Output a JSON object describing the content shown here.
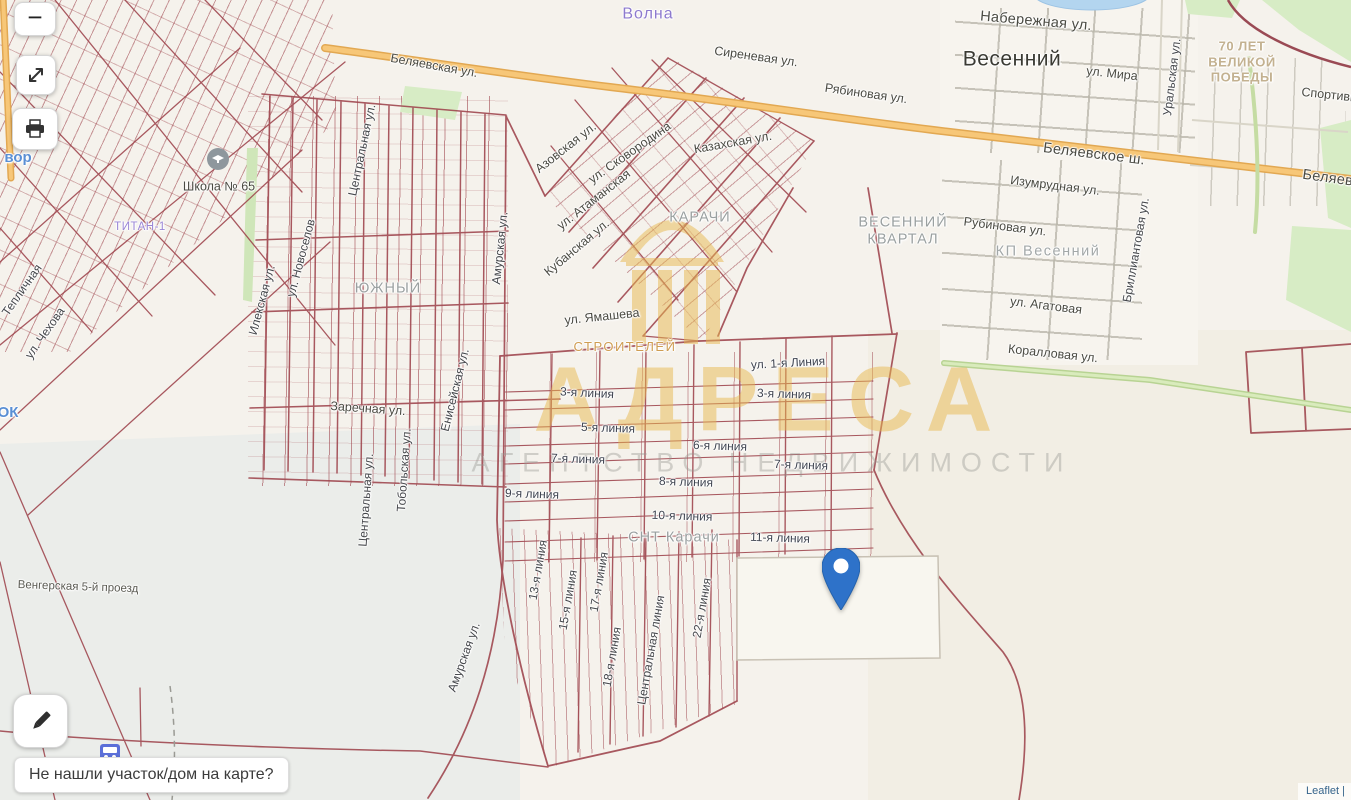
{
  "controls": {
    "zoom_out_glyph": "−"
  },
  "prompt": {
    "text": "Не нашли участок/дом на карте?"
  },
  "attribution": {
    "text": "Leaflet |"
  },
  "watermark": {
    "title": "АДРЕСА",
    "subtitle": "АГЕНТСТВО НЕДВИЖИМОСТИ"
  },
  "colors": {
    "pin": "#2e72c9",
    "parcel_line": "#a04850",
    "highway_orange": "#f7c778",
    "green_road": "#d3e7b4",
    "water": "#b3d5ef",
    "watermark_gold": "#e8b84e"
  },
  "labels": [
    {
      "name": "label-volna",
      "text": "Волна",
      "x": 648,
      "y": 14,
      "rot": 0,
      "cls": "purple"
    },
    {
      "name": "label-sirenevaya-ul",
      "text": "Сиреневая ул.",
      "x": 756,
      "y": 57,
      "rot": 8,
      "cls": "st"
    },
    {
      "name": "label-ryabinovaya-ul",
      "text": "Рябиновая ул.",
      "x": 866,
      "y": 94,
      "rot": 8,
      "cls": "st"
    },
    {
      "name": "label-belyaevskaya-ul-west",
      "text": "Беляевская ул.",
      "x": 434,
      "y": 66,
      "rot": 10,
      "cls": "st"
    },
    {
      "name": "label-naberezhnaya-ul",
      "text": "Набережная ул.",
      "x": 1036,
      "y": 22,
      "rot": 5,
      "cls": "st15"
    },
    {
      "name": "label-vesenniy",
      "text": "Весенний",
      "x": 1012,
      "y": 59,
      "rot": 0,
      "cls": "big"
    },
    {
      "name": "label-ul-mira",
      "text": "ул. Мира",
      "x": 1112,
      "y": 74,
      "rot": 6,
      "cls": "st"
    },
    {
      "name": "label-uralskaya-ul",
      "text": "Уральская ул.",
      "x": 1172,
      "y": 77,
      "rot": -83,
      "cls": "vert"
    },
    {
      "name": "label-70-let-velikoy-pobedy",
      "text": "70 ЛЕТ\nВЕЛИКОЙ\nПОБЕДЫ",
      "x": 1242,
      "y": 62,
      "rot": 0,
      "cls": "pobedy"
    },
    {
      "name": "label-sportivnaya",
      "text": "Спортивная",
      "x": 1336,
      "y": 96,
      "rot": 6,
      "cls": "st"
    },
    {
      "name": "label-belyaevskoe-sh",
      "text": "Беляевское ш.",
      "x": 1094,
      "y": 155,
      "rot": 7,
      "cls": "st15"
    },
    {
      "name": "label-belyaevskoe-east",
      "text": "Беляевское",
      "x": 1343,
      "y": 181,
      "rot": 8,
      "cls": "st15"
    },
    {
      "name": "label-izumrudnaya-ul",
      "text": "Изумрудная ул.",
      "x": 1055,
      "y": 186,
      "rot": 7,
      "cls": "st"
    },
    {
      "name": "label-rubinovaya-ul",
      "text": "Рубиновая ул.",
      "x": 1005,
      "y": 227,
      "rot": 7,
      "cls": "st"
    },
    {
      "name": "label-kp-vesenniy",
      "text": "КП Весенний",
      "x": 1048,
      "y": 252,
      "rot": 0,
      "cls": "kp"
    },
    {
      "name": "label-brilliantovaya-ul",
      "text": "Бриллиантовая ул.",
      "x": 1136,
      "y": 250,
      "rot": -80,
      "cls": "vert"
    },
    {
      "name": "label-ul-agatovaya",
      "text": "ул. Агатовая",
      "x": 1046,
      "y": 306,
      "rot": 7,
      "cls": "st"
    },
    {
      "name": "label-korallovaya-ul",
      "text": "Коралловая ул.",
      "x": 1053,
      "y": 354,
      "rot": 6,
      "cls": "st"
    },
    {
      "name": "label-vesenniy-kvartal",
      "text": "ВЕСЕННИЙ\nКВАРТАЛ",
      "x": 903,
      "y": 232,
      "rot": 0,
      "cls": "dist"
    },
    {
      "name": "label-karachi",
      "text": "КАРАЧИ",
      "x": 700,
      "y": 218,
      "rot": 0,
      "cls": "dist"
    },
    {
      "name": "label-stroiteley",
      "text": "СТРОИТЕЛЕЙ",
      "x": 625,
      "y": 347,
      "rot": 0,
      "cls": "tan"
    },
    {
      "name": "label-shkola-65",
      "text": "Школа № 65",
      "x": 219,
      "y": 187,
      "rot": 0,
      "cls": "st"
    },
    {
      "name": "label-yuzhny",
      "text": "ЮЖНЫЙ",
      "x": 388,
      "y": 289,
      "rot": 0,
      "cls": "dist"
    },
    {
      "name": "label-titan",
      "text": "ТИТАН-1",
      "x": 140,
      "y": 228,
      "rot": 0,
      "cls": "purplesm"
    },
    {
      "name": "label-ilekskaya-ul",
      "text": "Илекская ул.",
      "x": 262,
      "y": 300,
      "rot": -75,
      "cls": "vert"
    },
    {
      "name": "label-ul-novoselov",
      "text": "ул. Новоселов",
      "x": 301,
      "y": 258,
      "rot": -75,
      "cls": "vert"
    },
    {
      "name": "label-tsentralnaya-ul-n",
      "text": "Центральная ул.",
      "x": 362,
      "y": 150,
      "rot": -78,
      "cls": "vert"
    },
    {
      "name": "label-amurskaya-ul-n",
      "text": "Амурская ул.",
      "x": 500,
      "y": 248,
      "rot": -84,
      "cls": "vert"
    },
    {
      "name": "label-eniseyskaya-ul",
      "text": "Енисейская ул.",
      "x": 455,
      "y": 390,
      "rot": -76,
      "cls": "vert"
    },
    {
      "name": "label-tobolskaya-ul",
      "text": "Тобольская ул.",
      "x": 404,
      "y": 470,
      "rot": -86,
      "cls": "vert"
    },
    {
      "name": "label-tsentralnaya-ul-s",
      "text": "Центральная ул.",
      "x": 366,
      "y": 500,
      "rot": -86,
      "cls": "vert"
    },
    {
      "name": "label-zarechnaya-ul",
      "text": "Заречная ул.",
      "x": 368,
      "y": 409,
      "rot": 4,
      "cls": "st"
    },
    {
      "name": "label-amurskaya-ul-s",
      "text": "Амурская ул.",
      "x": 464,
      "y": 657,
      "rot": -70,
      "cls": "vert"
    },
    {
      "name": "label-ul-chehova",
      "text": "ул. Чехова",
      "x": 45,
      "y": 333,
      "rot": -55,
      "cls": "vert"
    },
    {
      "name": "label-teplichnaya",
      "text": "Тепличная",
      "x": 22,
      "y": 290,
      "rot": -55,
      "cls": "vert"
    },
    {
      "name": "label-5-proezd",
      "text": "Венгерская 5-й проезд",
      "x": 78,
      "y": 588,
      "rot": 2,
      "cls": "sm"
    },
    {
      "name": "label-ul-skovorodina",
      "text": "ул. Сковородина",
      "x": 630,
      "y": 153,
      "rot": -35,
      "cls": "st"
    },
    {
      "name": "label-kazahskaya-ul",
      "text": "Казахская ул.",
      "x": 733,
      "y": 143,
      "rot": -10,
      "cls": "st"
    },
    {
      "name": "label-azovskaya-ul",
      "text": "Азовская ул.",
      "x": 566,
      "y": 148,
      "rot": -38,
      "cls": "st"
    },
    {
      "name": "label-ul-atamanskaya",
      "text": "ул. Атаманская",
      "x": 594,
      "y": 200,
      "rot": -38,
      "cls": "st"
    },
    {
      "name": "label-kubanskaya-ul",
      "text": "Кубанская ул.",
      "x": 577,
      "y": 248,
      "rot": -40,
      "cls": "st"
    },
    {
      "name": "label-ul-yamasheva",
      "text": "ул. Ямашева",
      "x": 602,
      "y": 317,
      "rot": -6,
      "cls": "st"
    },
    {
      "name": "label-ul-1-liniya",
      "text": "ул. 1-я Линия",
      "x": 788,
      "y": 363,
      "rot": -3,
      "cls": "ln"
    },
    {
      "name": "label-3-liniya-w",
      "text": "3-я линия",
      "x": 587,
      "y": 393,
      "rot": 3,
      "cls": "ln"
    },
    {
      "name": "label-3-liniya-e",
      "text": "3-я линия",
      "x": 784,
      "y": 394,
      "rot": 2,
      "cls": "ln"
    },
    {
      "name": "label-5-liniya",
      "text": "5-я линия",
      "x": 608,
      "y": 428,
      "rot": 2,
      "cls": "ln"
    },
    {
      "name": "label-6-liniya",
      "text": "6-я линия",
      "x": 720,
      "y": 446,
      "rot": 2,
      "cls": "ln"
    },
    {
      "name": "label-7-liniya-w",
      "text": "7-я линия",
      "x": 578,
      "y": 459,
      "rot": 2,
      "cls": "ln"
    },
    {
      "name": "label-7-liniya-e",
      "text": "7-я линия",
      "x": 801,
      "y": 465,
      "rot": 2,
      "cls": "ln"
    },
    {
      "name": "label-8-liniya",
      "text": "8-я линия",
      "x": 686,
      "y": 482,
      "rot": 2,
      "cls": "ln"
    },
    {
      "name": "label-9-liniya",
      "text": "9-я линия",
      "x": 532,
      "y": 494,
      "rot": 2,
      "cls": "ln"
    },
    {
      "name": "label-10-liniya",
      "text": "10-я линия",
      "x": 682,
      "y": 516,
      "rot": 2,
      "cls": "ln"
    },
    {
      "name": "label-11-liniya",
      "text": "11-я линия",
      "x": 780,
      "y": 538,
      "rot": 2,
      "cls": "ln"
    },
    {
      "name": "label-snt-karachi",
      "text": "СНТ Карачи",
      "x": 674,
      "y": 538,
      "rot": 0,
      "cls": "dist"
    },
    {
      "name": "label-13-liniya",
      "text": "13-я линия",
      "x": 538,
      "y": 570,
      "rot": -80,
      "cls": "vert"
    },
    {
      "name": "label-15-liniya",
      "text": "15-я линия",
      "x": 568,
      "y": 600,
      "rot": -80,
      "cls": "vert"
    },
    {
      "name": "label-17-liniya",
      "text": "17-я линия",
      "x": 599,
      "y": 582,
      "rot": -80,
      "cls": "vert"
    },
    {
      "name": "label-18-liniya",
      "text": "18-я линия",
      "x": 612,
      "y": 657,
      "rot": -80,
      "cls": "vert"
    },
    {
      "name": "label-tsentralnaya-liniya",
      "text": "Центральная линия",
      "x": 651,
      "y": 650,
      "rot": -80,
      "cls": "vert"
    },
    {
      "name": "label-22-liniya",
      "text": "22-я линия",
      "x": 702,
      "y": 608,
      "rot": -80,
      "cls": "vert"
    },
    {
      "name": "label-poi-vor",
      "text": "вор",
      "x": 18,
      "y": 158,
      "rot": 0,
      "cls": "blue"
    },
    {
      "name": "label-poi-ok",
      "text": "ОК",
      "x": 8,
      "y": 413,
      "rot": 0,
      "cls": "blue"
    }
  ]
}
